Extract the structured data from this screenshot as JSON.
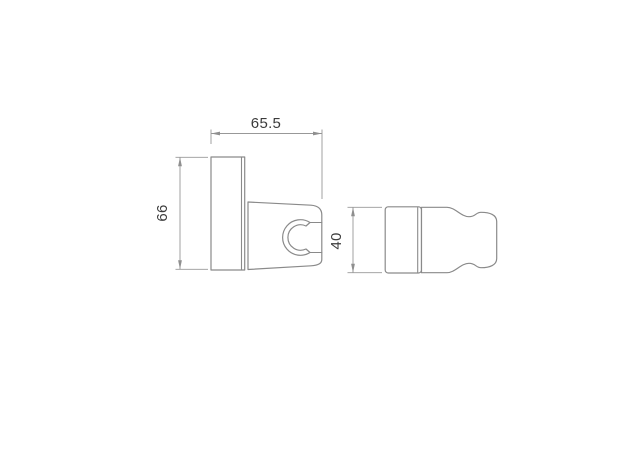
{
  "canvas": {
    "width_px": 641,
    "height_px": 468,
    "background": "#ffffff"
  },
  "drawing": {
    "kind": "technical-dimension-drawing",
    "subject": "wall-mount shower handset holder bracket, front view and side view",
    "colors": {
      "outline": "#8a8a8a",
      "dimension_line": "#989898",
      "label_text": "#3b3b3b"
    },
    "dimensions": {
      "width": {
        "value": "65.5"
      },
      "height": {
        "value": "66"
      },
      "depth": {
        "value": "40"
      }
    }
  }
}
